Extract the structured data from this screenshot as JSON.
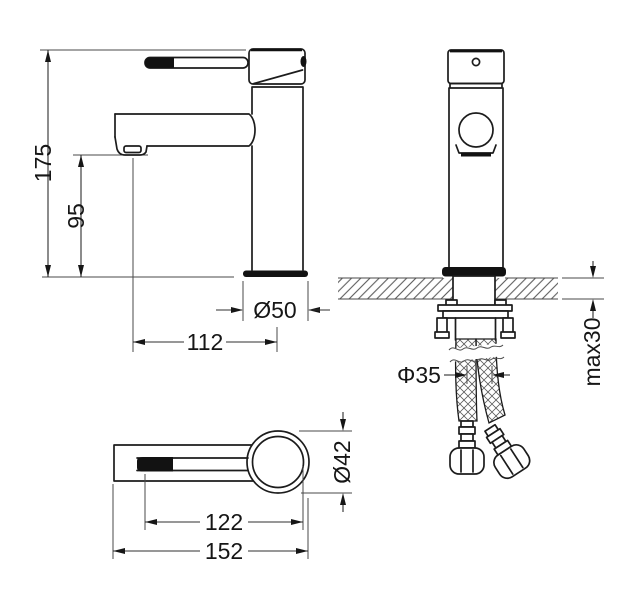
{
  "drawing": {
    "type": "technical-drawing",
    "subject": "single-lever basin faucet, three orthographic views with installation detail",
    "colors": {
      "line": "#1c1c1c",
      "background": "#ffffff",
      "solid_fill": "#121212"
    },
    "dimensions": {
      "overall_height": "175",
      "spout_height": "95",
      "base_diameter": "Ø50",
      "spout_reach": "112",
      "mount_hole_diameter": "Φ35",
      "max_deck_thickness": "max30",
      "body_diameter": "Ø42",
      "reach_to_center": "122",
      "overall_length": "152"
    }
  }
}
